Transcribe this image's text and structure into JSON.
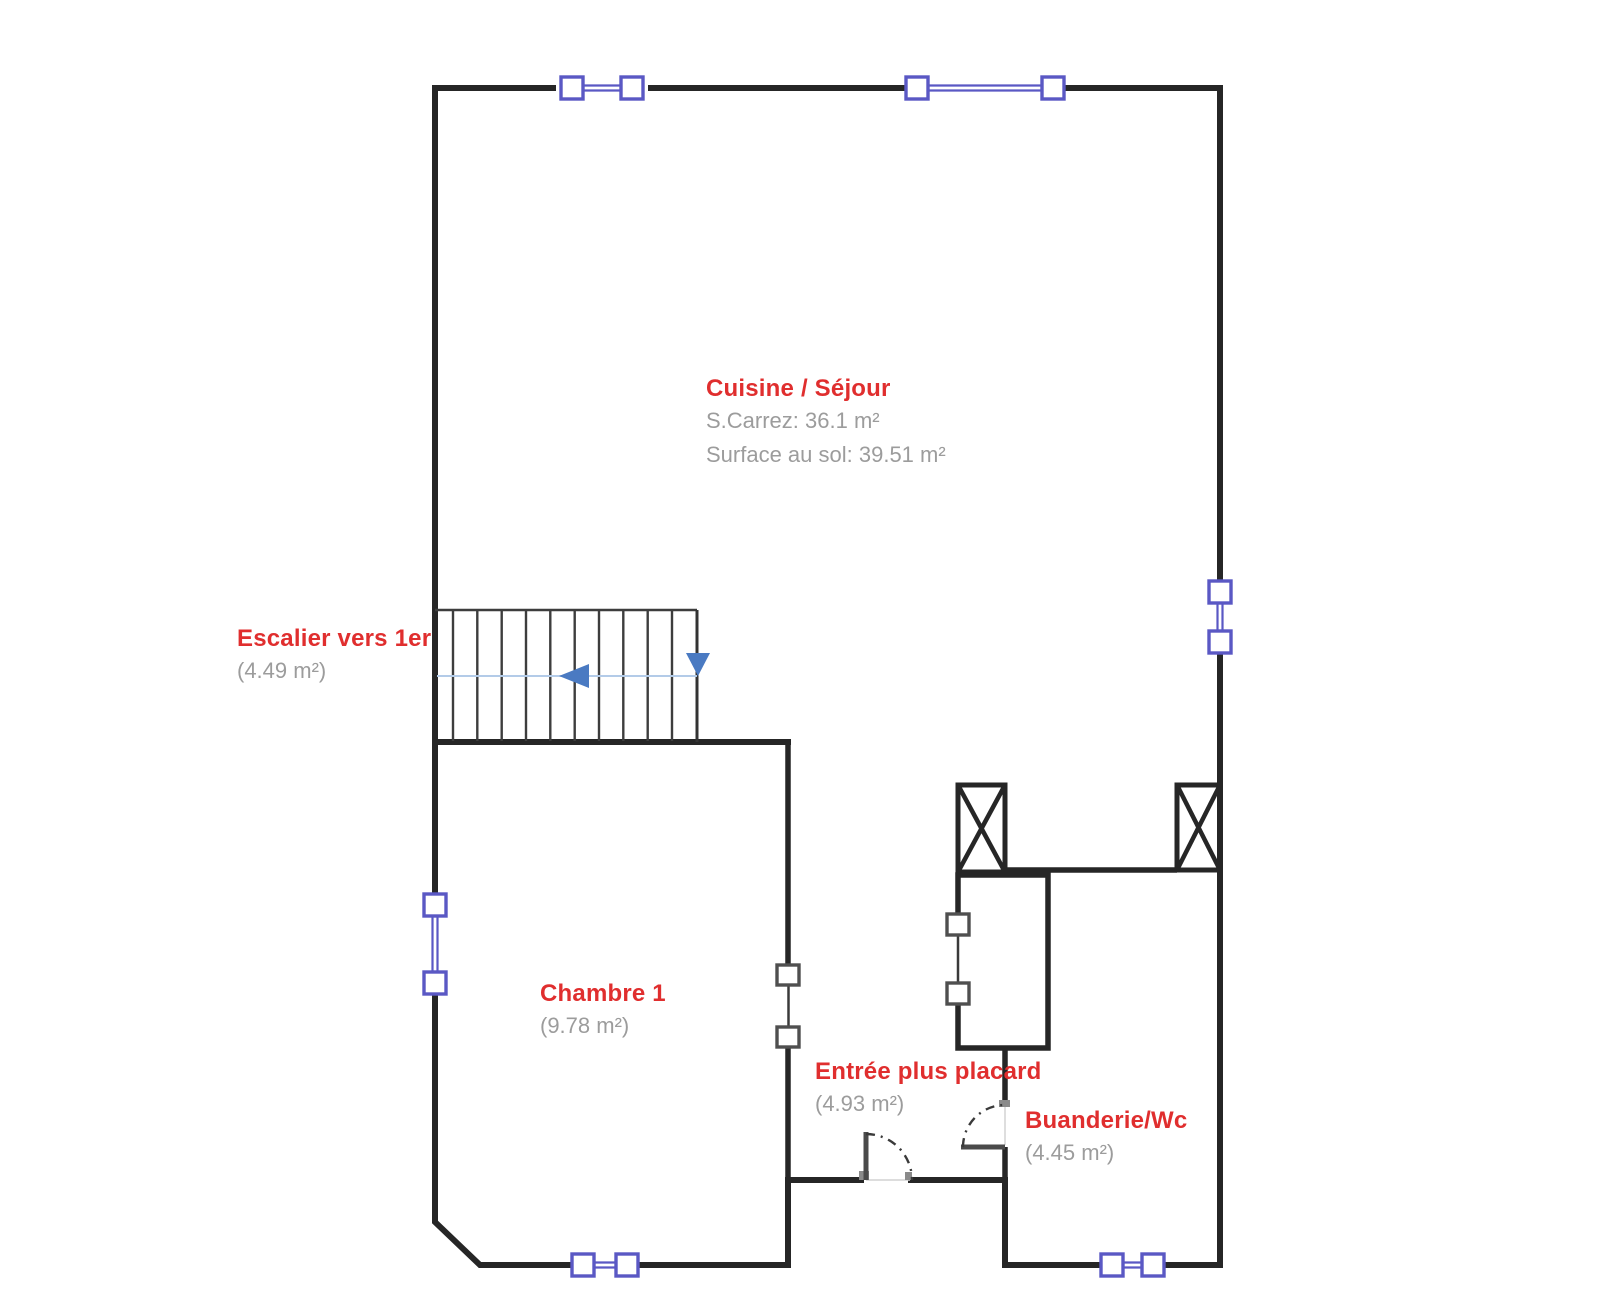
{
  "colors": {
    "wall": "#262626",
    "window": "#5a58c4",
    "arrow": "#4a7ac2",
    "guide": "#b3cbe8",
    "room_label": "#e02e2e",
    "area_label": "#9c9c9c"
  },
  "rooms": {
    "cuisine": {
      "name": "Cuisine / Séjour",
      "carrez": "S.Carrez: 36.1 m²",
      "floor": "Surface au sol: 39.51 m²"
    },
    "escalier": {
      "name": "Escalier vers 1er",
      "area": "(4.49 m²)"
    },
    "chambre": {
      "name": "Chambre 1",
      "area": "(9.78 m²)"
    },
    "entree": {
      "name": "Entrée plus placard",
      "area": "(4.93 m²)"
    },
    "buanderie": {
      "name": "Buanderie/Wc",
      "area": "(4.45 m²)"
    }
  }
}
